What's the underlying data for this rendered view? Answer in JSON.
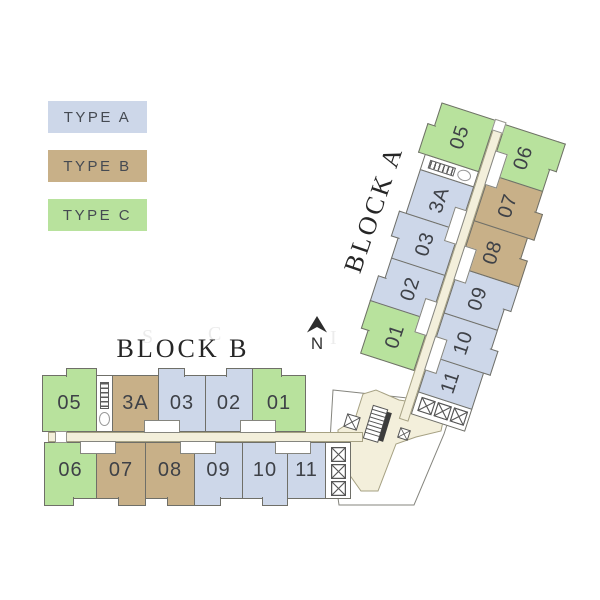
{
  "colors": {
    "type_a": "#cdd7e9",
    "type_b": "#c8b088",
    "type_c": "#b8e29d",
    "corridor": "#f3efdb",
    "corridor_border": "#a6a183",
    "wall": "#6f6f68",
    "label": "#3e4147"
  },
  "legend": {
    "items": [
      {
        "type": "A",
        "label": "TYPE A"
      },
      {
        "type": "B",
        "label": "TYPE B"
      },
      {
        "type": "C",
        "label": "TYPE C"
      }
    ]
  },
  "north_label": "N",
  "watermark": {
    "letters": [
      {
        "t": "S",
        "x": 142,
        "y": 326
      },
      {
        "t": "C",
        "x": 208,
        "y": 323
      },
      {
        "t": "I",
        "x": 330,
        "y": 327
      },
      {
        "t": "M",
        "x": 408,
        "y": 330
      }
    ]
  },
  "blocks": [
    {
      "id": "block-b",
      "title": "BLOCK B",
      "top_offset": 0,
      "bottom_offset": 2,
      "corridor": {
        "x": 5,
        "w": 315,
        "cap": "left"
      },
      "notches_top": [
        119,
        215
      ],
      "notches_bottom": [
        55,
        155,
        250
      ],
      "top_row": [
        {
          "no": "05",
          "type": "C",
          "w": 55,
          "step": "right"
        },
        {
          "core": true,
          "w": 17
        },
        {
          "no": "3A",
          "type": "B",
          "w": 47
        },
        {
          "no": "03",
          "type": "A",
          "w": 48,
          "step": "left"
        },
        {
          "no": "02",
          "type": "A",
          "w": 48,
          "step": "right"
        },
        {
          "no": "01",
          "type": "C",
          "w": 54,
          "step": "left"
        }
      ],
      "bottom_row": [
        {
          "no": "06",
          "type": "C",
          "w": 53,
          "step": "left"
        },
        {
          "no": "07",
          "type": "B",
          "w": 50,
          "step": "right"
        },
        {
          "no": "08",
          "type": "B",
          "w": 50,
          "step": "right"
        },
        {
          "no": "09",
          "type": "A",
          "w": 49,
          "step": "left"
        },
        {
          "no": "10",
          "type": "A",
          "w": 46,
          "step": "right"
        },
        {
          "no": "11",
          "type": "A",
          "w": 39
        },
        {
          "bank": true,
          "w": 26
        }
      ]
    },
    {
      "id": "block-a",
      "title": "BLOCK A",
      "top_offset": 51,
      "bottom_offset": 9,
      "corridor": {
        "x": 0,
        "w": 315,
        "cap": "right"
      },
      "notches_top": [
        105,
        201
      ],
      "notches_bottom": [
        72,
        167,
        267
      ],
      "top_row": [
        {
          "no": "01",
          "type": "C",
          "w": 54,
          "step": "right"
        },
        {
          "no": "02",
          "type": "A",
          "w": 48,
          "step": "left"
        },
        {
          "no": "03",
          "type": "A",
          "w": 48,
          "step": "right"
        },
        {
          "no": "3A",
          "type": "A",
          "w": 47
        },
        {
          "core": true,
          "w": 17
        },
        {
          "no": "05",
          "type": "C",
          "w": 55,
          "step": "left"
        }
      ],
      "bottom_row": [
        {
          "bank": true,
          "w": 24
        },
        {
          "no": "11",
          "type": "A",
          "w": 39
        },
        {
          "no": "10",
          "type": "A",
          "w": 46,
          "step": "left"
        },
        {
          "no": "09",
          "type": "A",
          "w": 49,
          "step": "right"
        },
        {
          "no": "08",
          "type": "B",
          "w": 50,
          "step": "left"
        },
        {
          "no": "07",
          "type": "B",
          "w": 50,
          "step": "left"
        },
        {
          "no": "06",
          "type": "C",
          "w": 53,
          "step": "right"
        }
      ]
    }
  ]
}
